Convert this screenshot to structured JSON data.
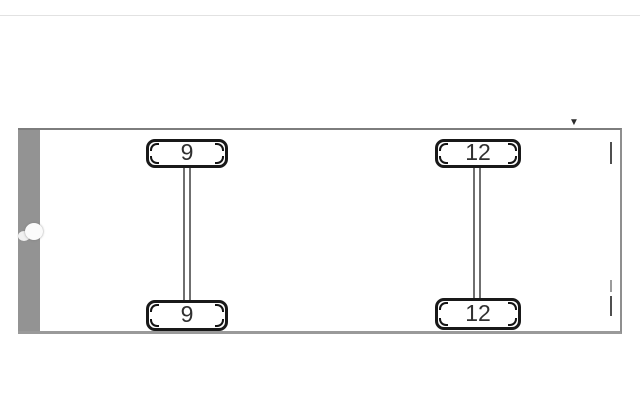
{
  "page": {
    "top_divider_color": "#e2e2e2",
    "background": "#ffffff"
  },
  "panel": {
    "dropdown_marker": "▼",
    "border_color": "#8f8f8f",
    "front_bar_color": "#939393",
    "tick_color": "#4f4f4f"
  },
  "diagram": {
    "type": "vehicle-axle-diagram-top-view",
    "axles": [
      {
        "name": "axle-1",
        "wheels": [
          {
            "position": "top",
            "label": "9"
          },
          {
            "position": "bottom",
            "label": "9"
          }
        ]
      },
      {
        "name": "axle-2",
        "wheels": [
          {
            "position": "top",
            "label": "12"
          },
          {
            "position": "bottom",
            "label": "12"
          }
        ]
      }
    ]
  },
  "colors": {
    "wheel_border": "#191919",
    "wheel_fill": "#ffffff",
    "wheel_label": "#303030",
    "axle_line": "#6f6f6f"
  }
}
